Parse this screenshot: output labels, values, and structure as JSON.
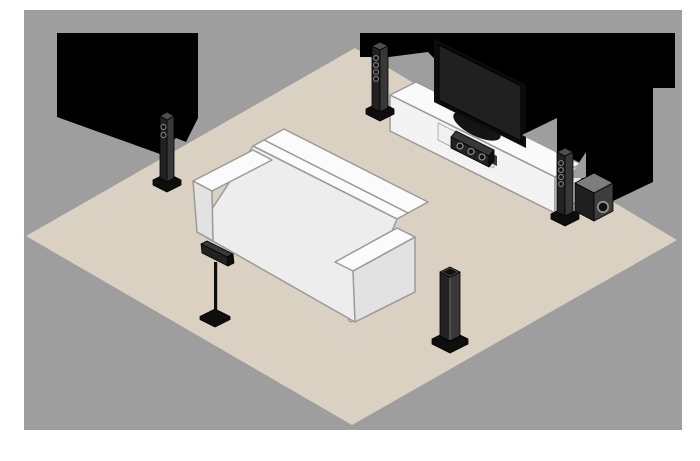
{
  "scene": {
    "title": "Isometric living-room illustration of a 5.1-channel home theater speaker placement",
    "objects": [
      {
        "id": "backdrop",
        "label": "gray wall backdrop"
      },
      {
        "id": "floor-rug",
        "label": "beige diamond floor area"
      },
      {
        "id": "wall-shadow-left",
        "label": "black shadow mass on left wall"
      },
      {
        "id": "wall-shadow-right",
        "label": "black shadow mass behind TV wall"
      },
      {
        "id": "sofa",
        "label": "white three-seat sofa facing the TV"
      },
      {
        "id": "tv-console",
        "label": "white low TV cabinet with open shelf"
      },
      {
        "id": "center-speaker",
        "label": "center channel speaker inside cabinet shelf"
      },
      {
        "id": "tv",
        "label": "flat-screen television on pedestal stand"
      },
      {
        "id": "front-left-speaker",
        "label": "front left tower speaker beside TV"
      },
      {
        "id": "front-right-speaker",
        "label": "front right tower speaker beside TV"
      },
      {
        "id": "subwoofer",
        "label": "subwoofer next to front right speaker"
      },
      {
        "id": "surround-left-speaker",
        "label": "surround left tower speaker on side wall"
      },
      {
        "id": "surround-back-speaker",
        "label": "surround speaker mounted on floor stand beside sofa"
      },
      {
        "id": "surround-right-speaker",
        "label": "surround right tower speaker at front of floor"
      }
    ],
    "colors": {
      "page_background": "#ffffff",
      "backdrop": "#9e9e9e",
      "floor": "#dbd1c2",
      "shadow": "#000000",
      "sofa_top": "#fbfbfb",
      "sofa_back": "#ededed",
      "sofa_side": "#e2e2e2",
      "console_top": "#fafafa",
      "console_front": "#f3f3f3",
      "console_side": "#e8e8e8",
      "shelf_interior": "#f0f0f0",
      "shelf_shadow": "#3a3a3a",
      "leg_white": "#f5f5f5",
      "tv_bezel": "#0c0c0c",
      "tv_screen": "#202020",
      "tv_stand": "#141414",
      "speaker_face": "#222222",
      "speaker_side": "#383838",
      "speaker_top": "#4e4e4e",
      "speaker_base": "#0e0e0e",
      "driver_ring": "#909090",
      "driver_hole": "#101010",
      "sub_top": "#7d7d7d",
      "sub_front": "#1f1f1f",
      "sub_side": "#3d3d3d"
    }
  }
}
